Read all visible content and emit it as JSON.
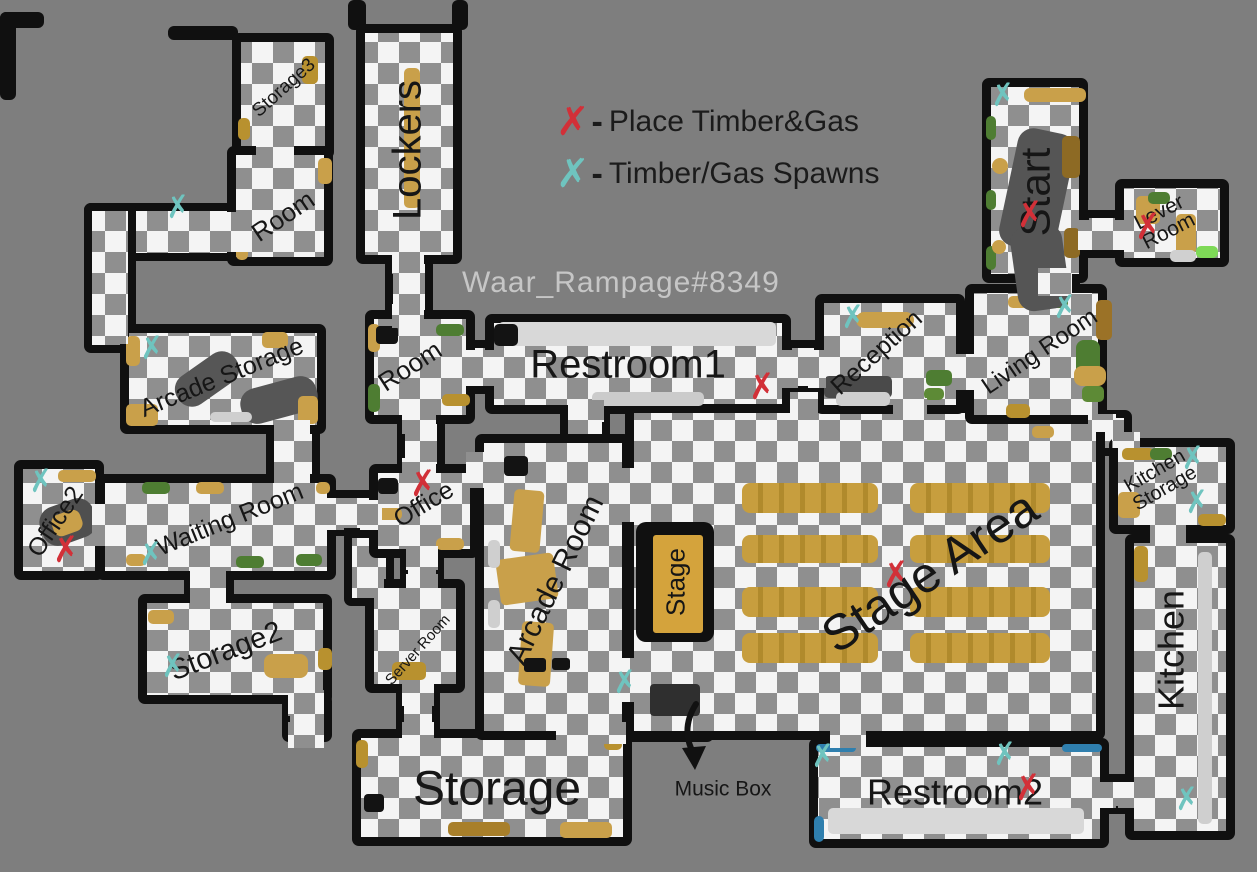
{
  "watermark": "Waar_Rampage#8349",
  "legend": {
    "symbol": "✗",
    "dash": "-",
    "place_label": "Place Timber&Gas",
    "spawn_label": "Timber/Gas Spawns"
  },
  "rooms": {
    "storage3": "Storage3",
    "lockers": "Lockers",
    "room_top": "Room",
    "arcade_storage": "Arcade Storage",
    "office2": "Office2",
    "waiting_room": "Waiting Room",
    "storage2": "Storage2",
    "room_mid": "Room",
    "office": "Office",
    "server_room": "Server Room",
    "storage_big": "Storage",
    "arcade_room": "Arcade Room",
    "restroom1": "Restroom1",
    "stage": "Stage",
    "stage_area": "Stage Area",
    "reception": "Reception",
    "living_room": "Living Room",
    "start": "Start",
    "lever_room": "Lever Room",
    "kitchen_storage": "Kitchen Storage",
    "kitchen": "Kitchen",
    "restroom2": "Restroom2"
  },
  "labels": {
    "music_box": "Music Box"
  },
  "colors": {
    "place_marker": "#d23038",
    "spawn_marker": "#6fc4bf",
    "walls": "#101010",
    "background": "#7e7e7e",
    "floor_light": "#f4f4f4",
    "floor_gray": "#8f8f8f",
    "furniture_tan": "#c9a04a"
  },
  "markers": {
    "place": [
      [
        423,
        484
      ],
      [
        66,
        550
      ],
      [
        762,
        387
      ],
      [
        896,
        575
      ],
      [
        1030,
        215
      ],
      [
        1148,
        227
      ],
      [
        1028,
        788
      ]
    ],
    "spawn": [
      [
        178,
        208
      ],
      [
        152,
        349
      ],
      [
        41,
        482
      ],
      [
        151,
        555
      ],
      [
        173,
        667
      ],
      [
        853,
        318
      ],
      [
        1065,
        308
      ],
      [
        1003,
        96
      ],
      [
        1193,
        459
      ],
      [
        1197,
        503
      ],
      [
        625,
        683
      ],
      [
        823,
        757
      ],
      [
        1005,
        755
      ],
      [
        1187,
        800
      ]
    ]
  }
}
